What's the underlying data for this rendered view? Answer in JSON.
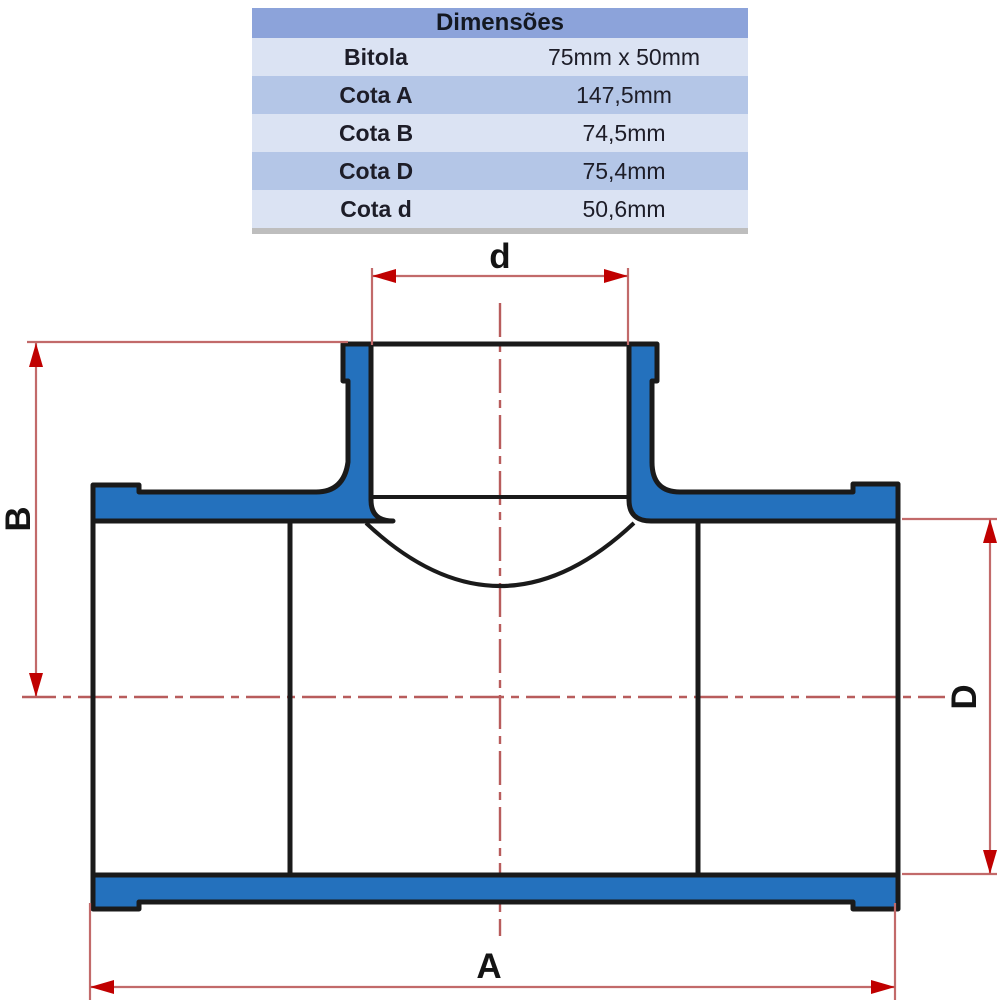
{
  "table": {
    "title": "Dimensões",
    "columns": [
      "label",
      "value"
    ],
    "rows": [
      {
        "label": "Bitola",
        "value": "75mm x 50mm"
      },
      {
        "label": "Cota A",
        "value": "147,5mm"
      },
      {
        "label": "Cota B",
        "value": "74,5mm"
      },
      {
        "label": "Cota D",
        "value": "75,4mm"
      },
      {
        "label": "Cota d",
        "value": "50,6mm"
      }
    ]
  },
  "diagram": {
    "description": "cross-section of a PVC soldable tee reducer fitting",
    "labels": {
      "top_branch_bore": "d",
      "left_height": "B",
      "right_outer_diameter": "D",
      "overall_length": "A"
    },
    "colors": {
      "fitting_fill": "#2471bd",
      "outline": "#1a1a1a",
      "dimension_red": "#c00000",
      "extension_line": "#c26a6a",
      "centerline": "#b85c5c"
    }
  }
}
